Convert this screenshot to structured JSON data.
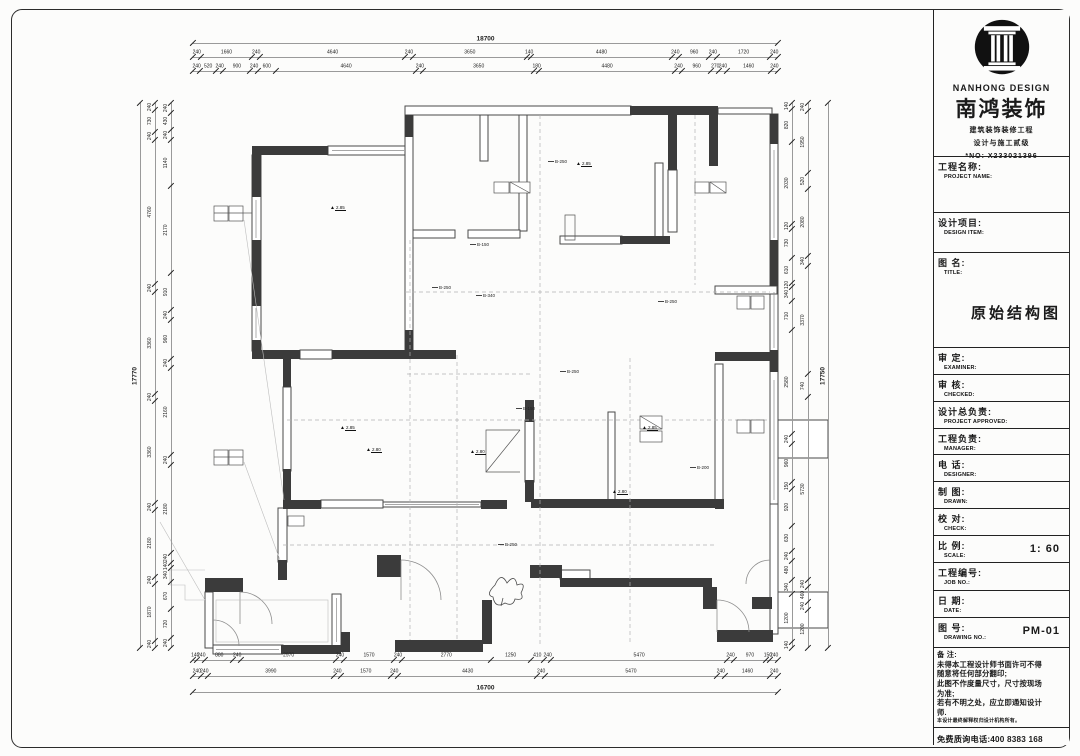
{
  "titleblock": {
    "logo": {
      "brand_en": "NANHONG DESIGN",
      "brand_cn": "南鸿装饰",
      "line1": "建筑装饰装修工程",
      "line2": "设计与施工贰级",
      "line3": "*NO: X233021396"
    },
    "project_name": {
      "cn": "工程名称:",
      "en": "PROJECT NAME:"
    },
    "design_item": {
      "cn": "设计项目:",
      "en": "DESIGN ITEM:"
    },
    "drawing_title": {
      "cn": "图  名:",
      "en": "TITLE:",
      "value": "原始结构图"
    },
    "rows": [
      {
        "cn": "审  定:",
        "en": "EXAMINER:",
        "value": ""
      },
      {
        "cn": "审  核:",
        "en": "CHECKED:",
        "value": ""
      },
      {
        "cn": "设计总负责:",
        "en": "PROJECT APPROVED:",
        "value": ""
      },
      {
        "cn": "工程负责:",
        "en": "MANAGER:",
        "value": ""
      },
      {
        "cn": "电  话:",
        "en": "DESIGNER:",
        "value": ""
      },
      {
        "cn": "制  图:",
        "en": "DRAWN:",
        "value": ""
      },
      {
        "cn": "校  对:",
        "en": "CHECK:",
        "value": ""
      },
      {
        "cn": "比  例:",
        "en": "SCALE:",
        "value": "1: 60"
      },
      {
        "cn": "工程编号:",
        "en": "JOB NO.:",
        "value": ""
      },
      {
        "cn": "日  期:",
        "en": "DATE:",
        "value": ""
      },
      {
        "cn": "图  号:",
        "en": "DRAWING NO.:",
        "value": "PM-01"
      }
    ],
    "notes": {
      "cn": "备  注:",
      "lines": [
        "未得本工程设计师书面许可不得",
        "随意将任何部分翻印;",
        "此图不作度量尺寸，尺寸按现场",
        "为准;",
        "若有不明之处，应立即通知设计",
        "师.",
        "本设计最终解释权归设计机构所有。"
      ]
    },
    "hotline": "免费质询电话:400 8383 168"
  },
  "plan": {
    "dim_chains": [
      {
        "dir": "h",
        "pos": 43,
        "x0": 193,
        "x1": 778,
        "vals": [
          18700
        ]
      },
      {
        "dir": "h",
        "pos": 57,
        "x0": 193,
        "x1": 778,
        "vals": [
          240,
          1660,
          240,
          4640,
          240,
          3650,
          140,
          4480,
          240,
          960,
          240,
          1720,
          240
        ]
      },
      {
        "dir": "h",
        "pos": 71,
        "x0": 193,
        "x1": 778,
        "vals": [
          240,
          520,
          240,
          900,
          240,
          600,
          4640,
          240,
          3650,
          180,
          4480,
          240,
          960,
          270,
          240,
          1460,
          240
        ]
      },
      {
        "dir": "h",
        "pos": 660,
        "x0": 193,
        "x1": 778,
        "vals": [
          140,
          240,
          880,
          240,
          2970,
          240,
          1570,
          240,
          2770,
          1250,
          410,
          240,
          5470,
          240,
          970,
          150,
          240
        ]
      },
      {
        "dir": "h",
        "pos": 676,
        "x0": 193,
        "x1": 778,
        "vals": [
          240,
          240,
          3990,
          240,
          1570,
          240,
          4430,
          240,
          5470,
          240,
          1460,
          240
        ]
      },
      {
        "dir": "h",
        "pos": 692,
        "x0": 193,
        "x1": 778,
        "vals": [
          16700
        ]
      },
      {
        "dir": "v",
        "pos": 140,
        "y0": 103,
        "y1": 648,
        "vals": [
          17770
        ]
      },
      {
        "dir": "v",
        "pos": 155,
        "y0": 103,
        "y1": 648,
        "vals": [
          240,
          730,
          240,
          4760,
          240,
          3360,
          240,
          3360,
          240,
          2180,
          240,
          1870,
          240
        ]
      },
      {
        "dir": "v",
        "pos": 171,
        "y0": 103,
        "y1": 648,
        "vals": [
          240,
          430,
          240,
          1140,
          2170,
          910,
          240,
          960,
          240,
          2160,
          240,
          2180,
          240,
          140,
          340,
          670,
          720,
          240
        ]
      },
      {
        "dir": "v",
        "pos": 792,
        "y0": 103,
        "y1": 648,
        "vals": [
          140,
          820,
          2030,
          120,
          730,
          610,
          120,
          340,
          710,
          2580,
          240,
          960,
          150,
          920,
          630,
          240,
          480,
          340,
          1200,
          140
        ]
      },
      {
        "dir": "v",
        "pos": 808,
        "y0": 103,
        "y1": 648,
        "vals": [
          240,
          1950,
          520,
          2080,
          340,
          3370,
          740,
          5730,
          240,
          460,
          240,
          1200
        ]
      },
      {
        "dir": "v",
        "pos": 828,
        "y0": 103,
        "y1": 648,
        "vals": [
          17750
        ]
      }
    ],
    "beam_labels": [
      {
        "t": "B-250",
        "x": 548,
        "y": 160
      },
      {
        "t": "B-150",
        "x": 470,
        "y": 243
      },
      {
        "t": "B-250",
        "x": 432,
        "y": 286
      },
      {
        "t": "B-340",
        "x": 476,
        "y": 294
      },
      {
        "t": "B-150",
        "x": 516,
        "y": 407
      },
      {
        "t": "B-250",
        "x": 658,
        "y": 300
      },
      {
        "t": "B-200",
        "x": 690,
        "y": 466
      },
      {
        "t": "B-250",
        "x": 498,
        "y": 543
      },
      {
        "t": "B-250",
        "x": 560,
        "y": 370
      }
    ],
    "level_markers": [
      {
        "t": "2.85",
        "x": 330,
        "y": 206
      },
      {
        "t": "2.85",
        "x": 576,
        "y": 162
      },
      {
        "t": "2.85",
        "x": 340,
        "y": 426
      },
      {
        "t": "2.85",
        "x": 642,
        "y": 426
      },
      {
        "t": "2.80",
        "x": 366,
        "y": 448
      },
      {
        "t": "2.80",
        "x": 470,
        "y": 450
      },
      {
        "t": "2.80",
        "x": 612,
        "y": 490
      }
    ]
  }
}
